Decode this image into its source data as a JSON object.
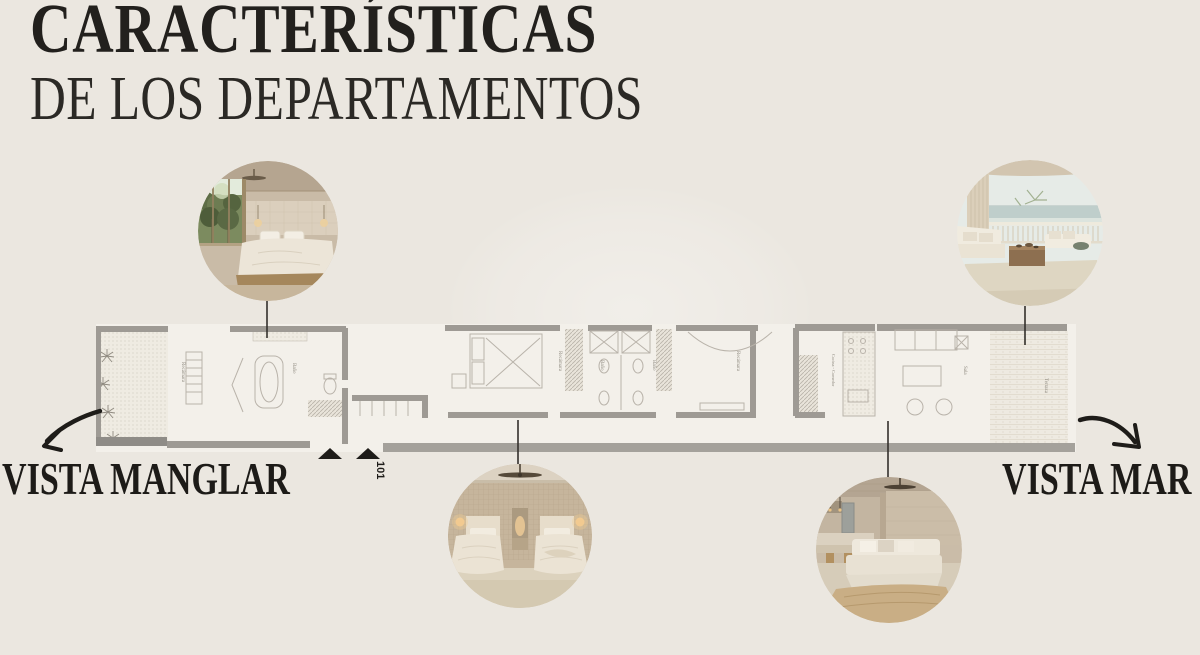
{
  "colors": {
    "background": "#ebe7e0",
    "ink": "#1d1b18",
    "plan_fill": "#f3f0ea",
    "plan_wall": "#9e9a94",
    "leader_line": "#33302b"
  },
  "header": {
    "title_line1": "CARACTERÍSTICAS",
    "title_line2": "DE LOS DEPARTAMENTOS"
  },
  "callouts": {
    "left_label": "VISTA MANGLAR",
    "right_label": "VISTA MAR"
  },
  "floor_plan": {
    "unit_number": "101",
    "rooms": {
      "bedroom_main": "Recámara",
      "bath_main": "Baño",
      "bedroom_2": "Recámara",
      "bath_2": "Baño",
      "bath_3": "Baño",
      "bedroom_3": "Recámara",
      "kitchen_dining": "Cocina - Comedor",
      "living": "Sala",
      "terrace_sea": "Terraza"
    }
  },
  "photos": {
    "top_left": {
      "alt": "Recámara con vista al manglar"
    },
    "top_right": {
      "alt": "Terraza con vista al mar"
    },
    "bottom_left": {
      "alt": "Recámara con dos camas"
    },
    "bottom_right": {
      "alt": "Sala y cocina"
    }
  }
}
